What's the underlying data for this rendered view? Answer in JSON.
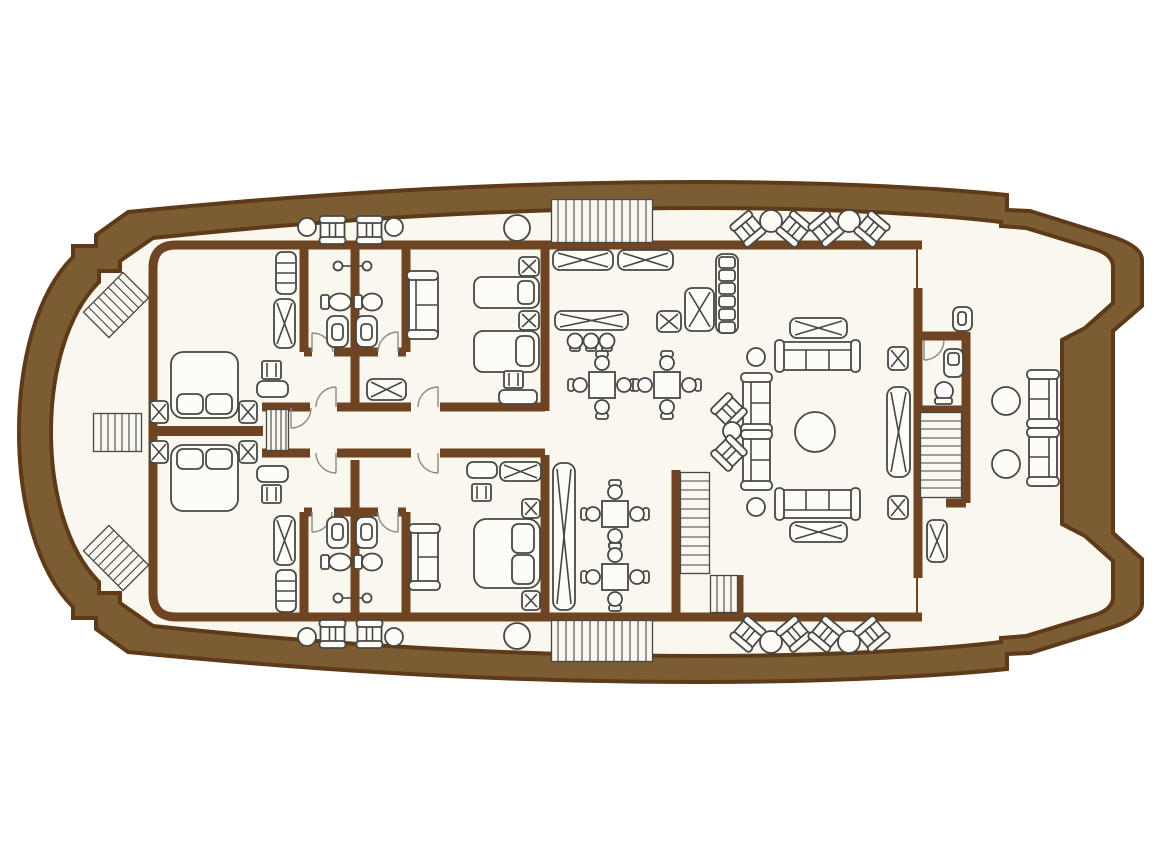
{
  "title": "Motor yacht main deck floor plan",
  "type": "floor-plan",
  "colors": {
    "page": "#ffffff",
    "deck": "#faf7ee",
    "hull_band": "#7b5c33",
    "hull_edge": "#5e3a19",
    "wall": "#6f4423",
    "furniture_line": "#474747",
    "furniture_fill": "#fdfcf6",
    "door_arc": "#8a8a8a"
  },
  "orientation": {
    "bow": "left",
    "stern": "right"
  },
  "rooms": [
    {
      "name": "bow-deck",
      "furniture": [
        "boarding-ladder",
        "boarding-ladder",
        "deck-steps"
      ]
    },
    {
      "name": "port-walkway",
      "furniture": [
        "side-table",
        "deck-chair",
        "deck-chair",
        "side-table",
        "round-table",
        "wide-deck-stairs",
        "chair-table-chair-group",
        "chair-table-chair-group"
      ]
    },
    {
      "name": "starboard-walkway",
      "furniture": [
        "side-table",
        "deck-chair",
        "deck-chair",
        "side-table",
        "round-table",
        "wide-deck-stairs",
        "chair-table-chair-group",
        "chair-table-chair-group"
      ]
    },
    {
      "name": "forward-port-cabin",
      "furniture": [
        "bench",
        "wardrobe",
        "double-bed",
        "nightstand",
        "nightstand",
        "vanity-table",
        "stool"
      ]
    },
    {
      "name": "forward-starboard-cabin",
      "furniture": [
        "bench",
        "wardrobe",
        "double-bed",
        "nightstand",
        "nightstand",
        "vanity-table",
        "stool"
      ]
    },
    {
      "name": "bathroom-forward-port",
      "furniture": [
        "shower",
        "washbasin",
        "toilet"
      ]
    },
    {
      "name": "bathroom-midship-port",
      "furniture": [
        "shower",
        "washbasin",
        "toilet"
      ]
    },
    {
      "name": "bathroom-forward-starboard",
      "furniture": [
        "shower",
        "washbasin",
        "toilet"
      ]
    },
    {
      "name": "bathroom-midship-starboard",
      "furniture": [
        "shower",
        "washbasin",
        "toilet"
      ]
    },
    {
      "name": "midship-port-cabin",
      "furniture": [
        "sofa",
        "single-bed",
        "single-bed",
        "nightstand",
        "nightstand",
        "sideboard",
        "vanity-table",
        "stool"
      ]
    },
    {
      "name": "midship-starboard-cabin",
      "furniture": [
        "sofa",
        "double-bed",
        "nightstand",
        "nightstand",
        "sideboard",
        "vanity-table",
        "stool"
      ]
    },
    {
      "name": "central-corridor",
      "furniture": [
        "companionway-steps",
        "cabin-door",
        "cabin-door",
        "cabin-door",
        "cabin-door"
      ]
    },
    {
      "name": "salon-dining",
      "furniture": [
        "sideboard",
        "sideboard",
        "buffet-counter",
        "bar-stool",
        "bar-stool",
        "bar-stool",
        "dining-table-with-4-chairs",
        "dining-table-with-4-chairs",
        "dining-table-with-4-chairs",
        "dining-table-with-4-chairs",
        "bar-shelf-unit",
        "cabinet",
        "side-table",
        "tall-locker"
      ]
    },
    {
      "name": "salon-lounge",
      "furniture": [
        "sofa",
        "sofa",
        "sofa",
        "sofa",
        "armchair",
        "armchair",
        "round-coffee-table",
        "coffee-table",
        "coffee-table",
        "side-table",
        "side-table",
        "side-table",
        "tall-cabinet",
        "nightstand",
        "nightstand"
      ]
    },
    {
      "name": "central-stairwell",
      "furniture": [
        "l-shaped-staircase"
      ]
    },
    {
      "name": "aft-stairwell",
      "furniture": [
        "staircase"
      ]
    },
    {
      "name": "aft-day-head",
      "furniture": [
        "toilet",
        "washbasin"
      ]
    },
    {
      "name": "aft-deck",
      "furniture": [
        "sofa",
        "sofa",
        "round-table",
        "round-table",
        "drink-station",
        "locker"
      ]
    }
  ],
  "counts": {
    "guest_cabins": 4,
    "bathrooms": 5,
    "staircases": 6,
    "dining_tables": 4,
    "sofas": 9
  }
}
